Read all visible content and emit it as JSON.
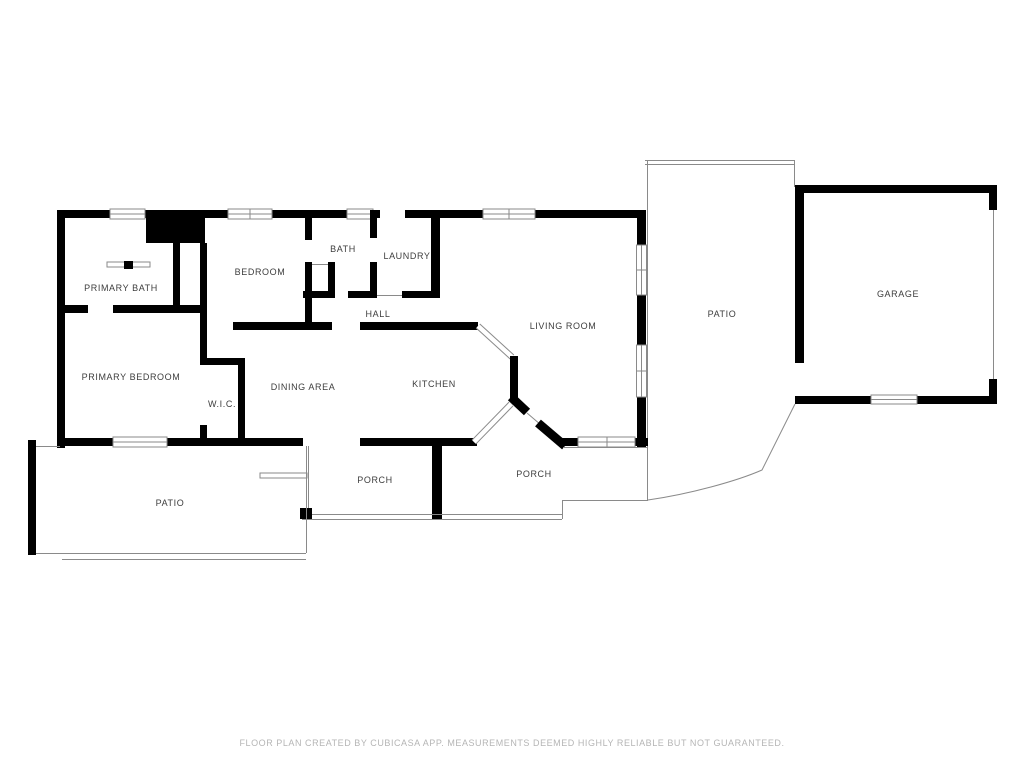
{
  "plan": {
    "room_labels": {
      "primary_bath": "PRIMARY BATH",
      "primary_bedroom": "PRIMARY BEDROOM",
      "wic": "W.I.C.",
      "bedroom": "BEDROOM",
      "bath": "BATH",
      "laundry": "LAUNDRY",
      "hall": "HALL",
      "dining_area": "DINING AREA",
      "kitchen": "KITCHEN",
      "living_room": "LIVING ROOM",
      "patio_right": "PATIO",
      "patio_left": "PATIO",
      "porch_left": "PORCH",
      "porch_right": "PORCH",
      "garage": "GARAGE"
    },
    "footer_text": "FLOOR PLAN CREATED BY CUBICASA APP. MEASUREMENTS DEEMED HIGHLY RELIABLE BUT NOT GUARANTEED.",
    "colors": {
      "wall_color": "#000000",
      "thin_color": "#8a8a8a",
      "label_color": "#3d3d3d",
      "footer_color": "#b5b5b5",
      "bg_color": "#ffffff"
    }
  }
}
